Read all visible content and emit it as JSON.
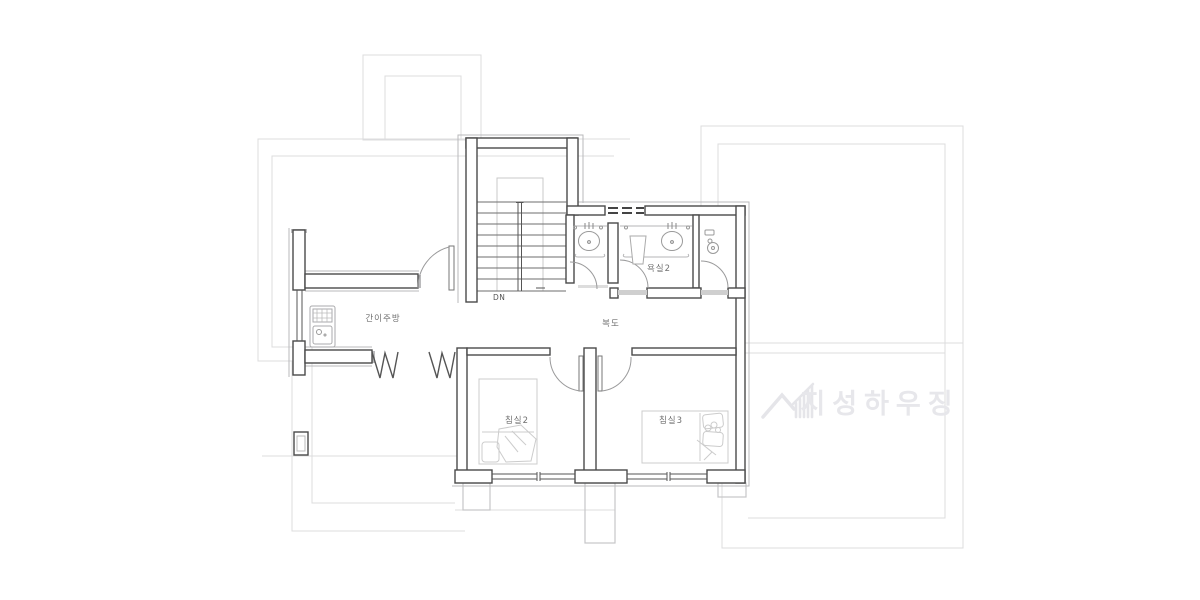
{
  "drawing": {
    "kind": "architectural floor plan",
    "rooms": {
      "kitchenette": "간이주방",
      "hallway": "복도",
      "bathroom2": "욕실2",
      "bedroom2": "침실2",
      "bedroom3": "침실3"
    },
    "stairs": {
      "direction_label": "DN"
    },
    "symbols": {
      "void_railing": "W W zigzag (open-to-below railing)",
      "fixtures": [
        "kitchen-sink",
        "bathroom-sink",
        "bathroom-sink",
        "toilet",
        "bed",
        "bed"
      ]
    },
    "watermark": {
      "text": "지성하우징",
      "logo": "mountain-and-building-logo"
    },
    "colors": {
      "background": "#ffffff",
      "wall": "#4a4a4a",
      "wall_offset": "#b9b9bb",
      "underlay_outline": "#dcdcde",
      "fixture": "#b5b5b7",
      "bed": "#cccccc",
      "door_arc": "#9a9a9b",
      "label": "#707070",
      "watermark": "#e7e7eb"
    }
  }
}
